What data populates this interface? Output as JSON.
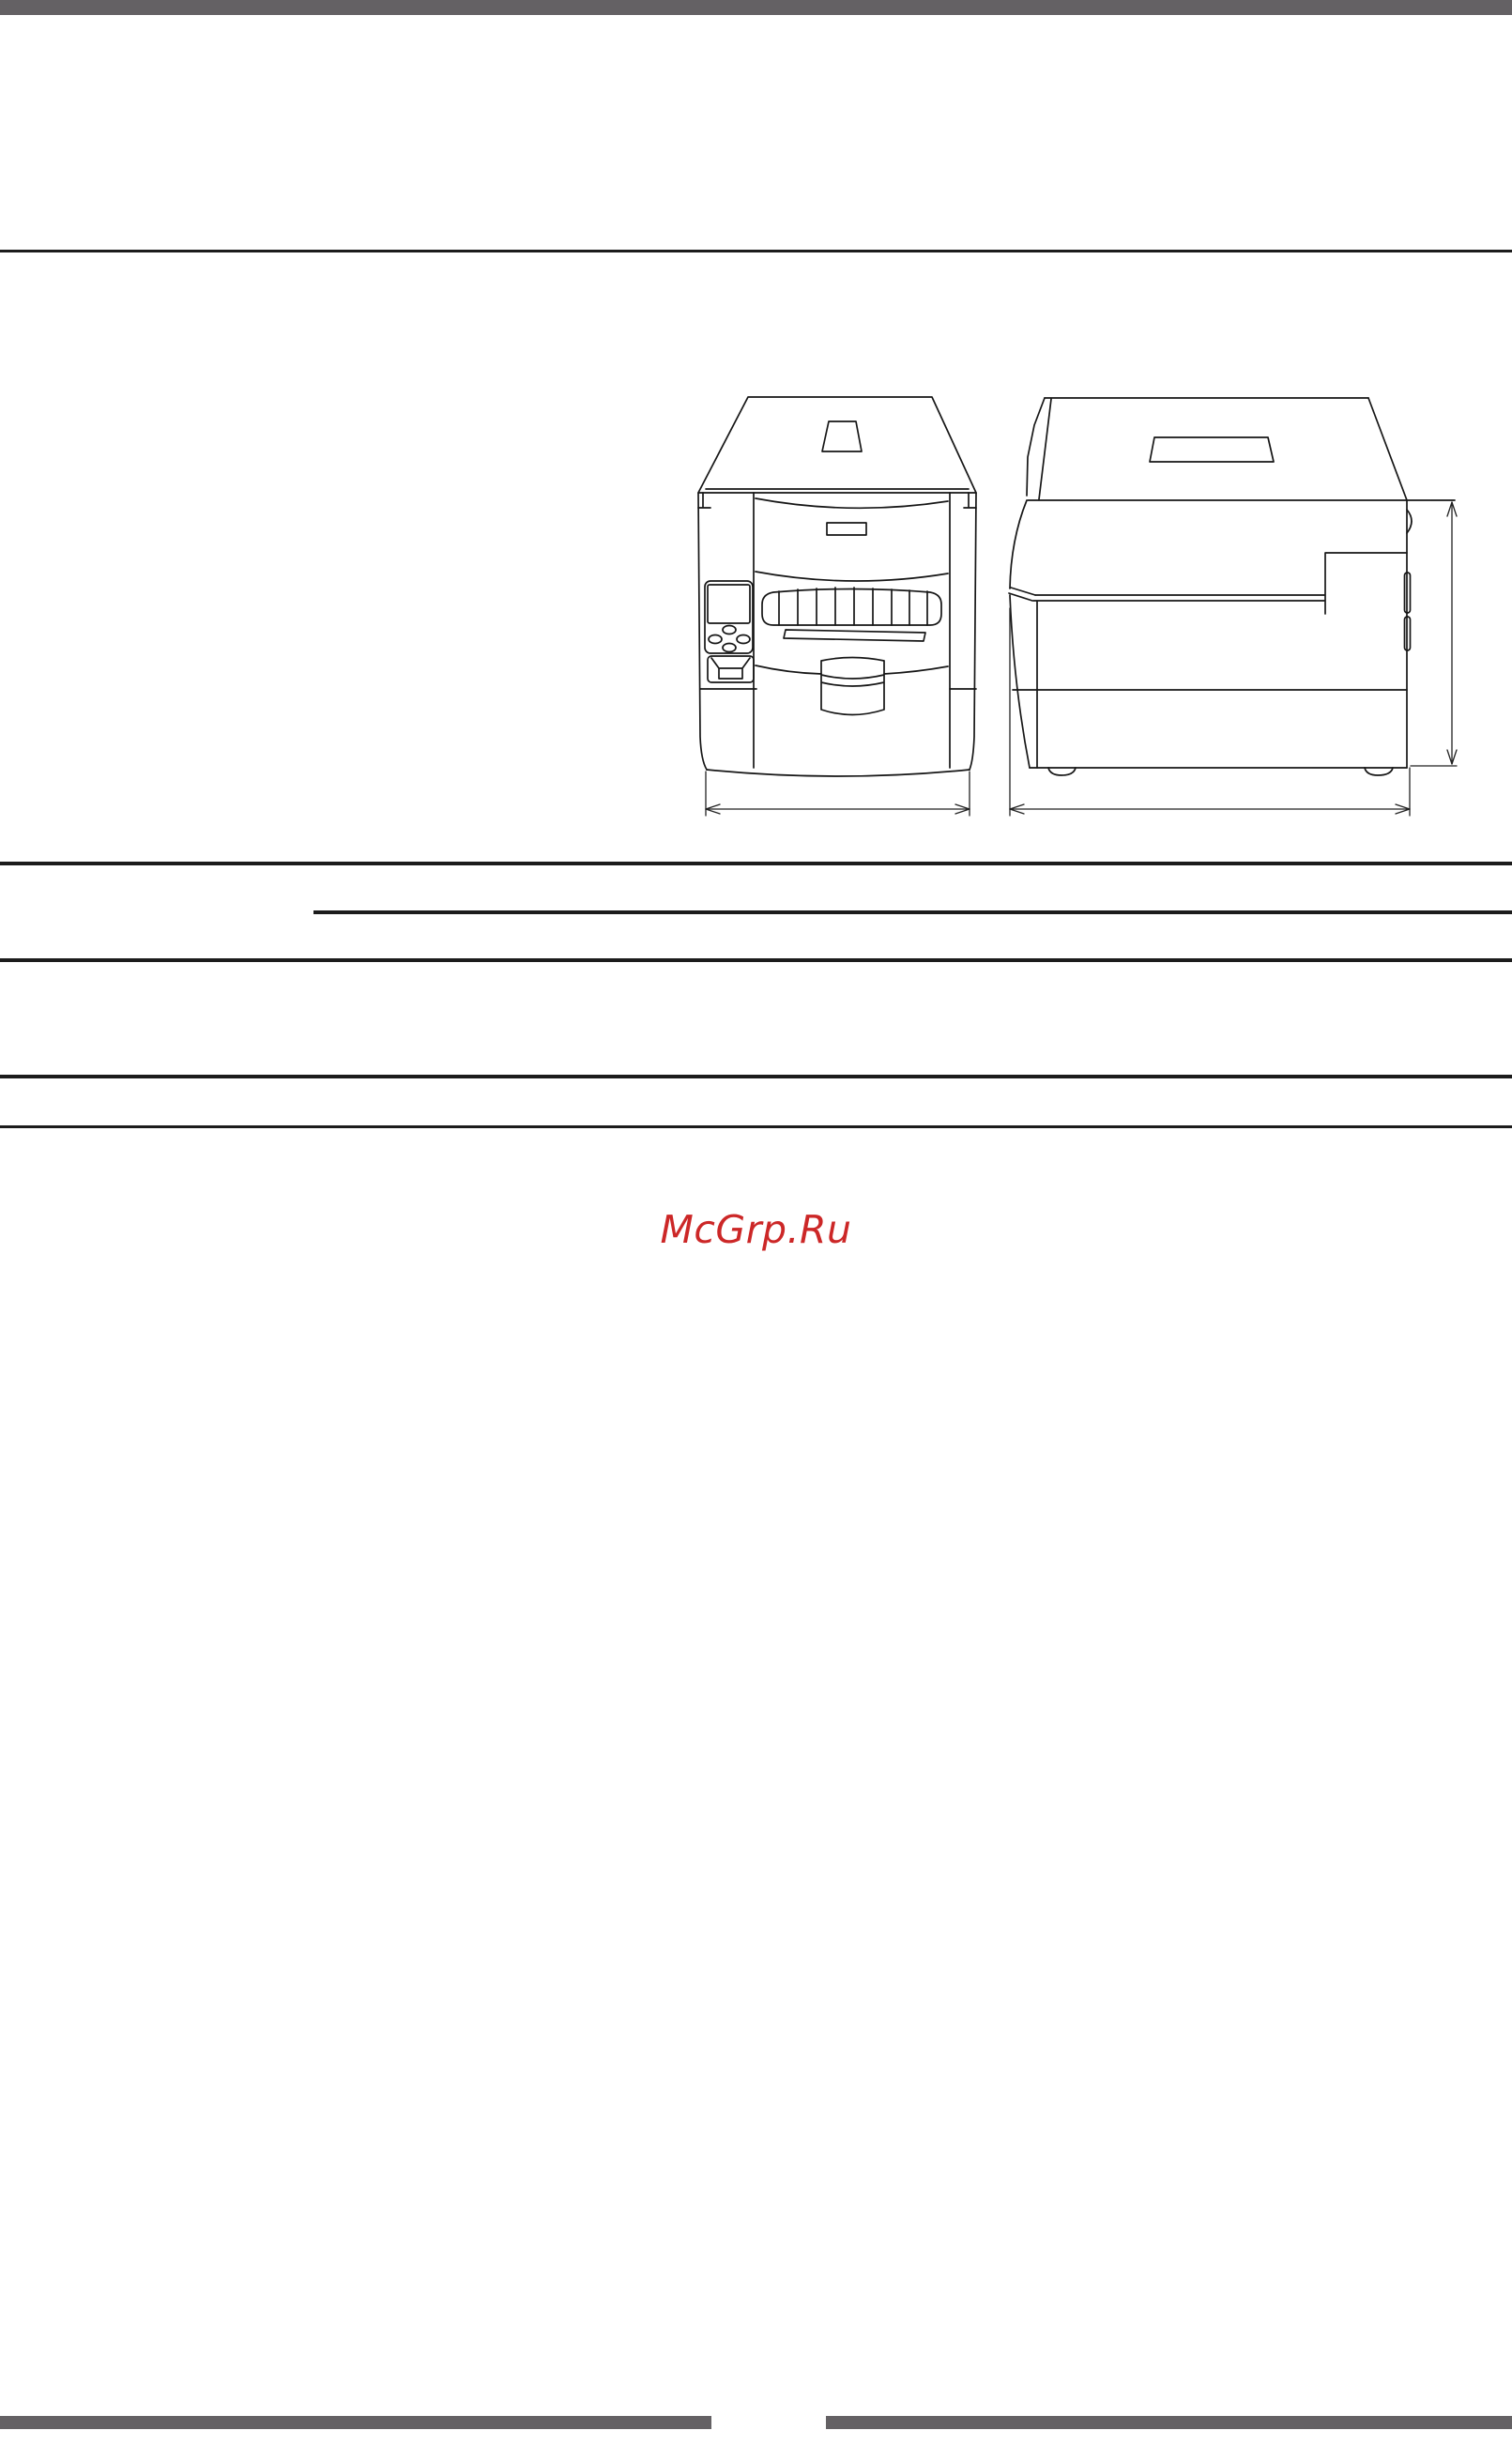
{
  "page": {
    "background_color": "#ffffff"
  },
  "chrome": {
    "top_bar_color": "#646164",
    "footer_bar_color": "#646164",
    "rule_color": "#1c1c1c"
  },
  "figure": {
    "stroke_color": "#161616",
    "dimension_stroke_color": "#222222"
  },
  "watermark": {
    "text": "McGrp.Ru",
    "color": "#cc2727"
  }
}
